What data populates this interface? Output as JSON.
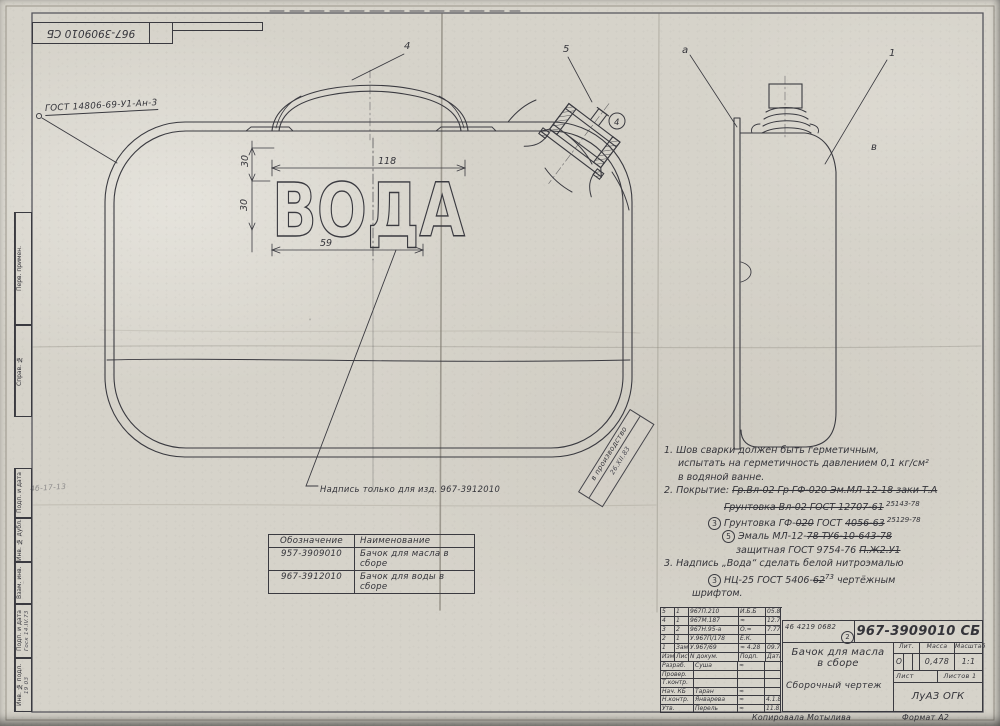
{
  "sheet": {
    "top_doc_number": "967-3909010 СБ",
    "gost_callout": "ГОСТ 14806-69-У1-Ан-3",
    "word_mark": "ВОДА",
    "inscription_note": "Надпись только для изд. 967-3912010",
    "stamp_line1": "в производство",
    "stamp_line2": "26.XII.83",
    "left_scrawl": "4б-17-13",
    "copied_by": "Копировала  Мотылива",
    "format_label": "Формат А2"
  },
  "dims": {
    "w118": "118",
    "w59": "59",
    "h30a": "30",
    "h30b": "30"
  },
  "callouts": {
    "handle": "4",
    "neck": "5",
    "cap": "4",
    "view_a": "а",
    "item1": "1",
    "view_v": "в"
  },
  "notes": [
    {
      "x": 0,
      "seg": [
        {
          "t": "1.  Шов сварки должен быть герметичным,"
        }
      ]
    },
    {
      "x": 14,
      "seg": [
        {
          "t": "испытать на герметичность давлением 0,1 кг/см²"
        }
      ]
    },
    {
      "x": 14,
      "seg": [
        {
          "t": "в водяной ванне."
        }
      ]
    },
    {
      "x": 0,
      "seg": [
        {
          "t": "2.  Покрытие: "
        },
        {
          "t": "Гр.Вл-02 Гр ГФ-020 Эм.МЛ-12-18 заки Т.А",
          "s": true
        }
      ]
    },
    {
      "x": 60,
      "seg": [
        {
          "t": "Грунтовка Вл-02 ГОСТ 12707-61",
          "s": true
        },
        {
          "t": " 25143-78",
          "sup": true
        }
      ]
    },
    {
      "x": 44,
      "seg": [
        {
          "c": "3"
        },
        {
          "t": "  Грунтовка ГФ-"
        },
        {
          "t": "020",
          "s": true
        },
        {
          "t": " ГОСТ "
        },
        {
          "t": "4056-63",
          "s": true
        },
        {
          "t": " 25129-78",
          "sup": true
        }
      ]
    },
    {
      "x": 58,
      "seg": [
        {
          "c": "5"
        },
        {
          "t": "  Эмаль МЛ-12-"
        },
        {
          "t": "78 ТУ6-10-643-78",
          "s": true
        }
      ]
    },
    {
      "x": 72,
      "seg": [
        {
          "t": "защитная ГОСТ 9754-76 "
        },
        {
          "t": "П.Ж2.У1",
          "s": true
        }
      ]
    },
    {
      "x": 0,
      "seg": [
        {
          "t": "3.  Надпись „Вода“ сделать белой нитроэмалью"
        }
      ]
    },
    {
      "x": 44,
      "seg": [
        {
          "c": "3"
        },
        {
          "t": "  НЦ-25 ГОСТ 5406-"
        },
        {
          "t": "62",
          "s": true
        },
        {
          "t": "73",
          "sup": true
        },
        {
          "t": " чертёжным"
        }
      ]
    },
    {
      "x": 28,
      "seg": [
        {
          "t": "шрифтом."
        }
      ]
    }
  ],
  "parts_table": {
    "headers": [
      "Обозначение",
      "Наименование"
    ],
    "rows": [
      [
        "957-3909010",
        "Бачок для масла в сборе"
      ],
      [
        "967-3912010",
        "Бачок для воды в сборе"
      ]
    ]
  },
  "title_block": {
    "code": "46 4219 0682",
    "code_circle": "2",
    "doc_number": "967-3909010 СБ",
    "title1": "Бачок для масла",
    "title2": "в сборе",
    "doc_type": "Сборочный чертеж",
    "lit_label": "Лит.",
    "lit_value": "О",
    "mass_label": "Масса",
    "mass_value": "0,478",
    "scale_label": "Масштаб",
    "scale_value": "1:1",
    "sheet_label": "Лист",
    "sheets_label": "Листов 1",
    "org": "ЛуАЗ  ОГК",
    "rev_header": [
      "Изм.",
      "Лист",
      "N докум.",
      "Подп.",
      "Дата"
    ],
    "rev_rows": [
      [
        "5",
        "1",
        "967П.210",
        "И.Б.Б",
        "05.81"
      ],
      [
        "4",
        "1",
        "967М.187",
        "≈",
        "12.78"
      ],
      [
        "3",
        "2",
        "967Н.95-а",
        "О.≈",
        "7.77"
      ],
      [
        "2",
        "1",
        "У.967П/178",
        "Е.К.",
        ""
      ],
      [
        "1",
        "Зам.",
        "У.967/69",
        "≈ 4.28",
        "09.76"
      ]
    ],
    "staff_rows": [
      [
        "Разраб.",
        "Суша",
        "≈",
        ""
      ],
      [
        "Провер.",
        "",
        "",
        ""
      ],
      [
        "Т.контр.",
        "",
        "",
        ""
      ],
      [
        "Нач. КБ",
        "Таран",
        "≈",
        ""
      ],
      [
        "Н.контр.",
        "Январева",
        "≈",
        "4.1.83"
      ],
      [
        "Утв.",
        "Перель",
        "≈",
        "11.81"
      ]
    ]
  },
  "margin_labels": [
    {
      "label": "Перв. примен.",
      "value": ""
    },
    {
      "label": "Справ. №",
      "value": ""
    },
    {
      "label": "Подп. и дата",
      "value": ""
    },
    {
      "label": "Инв. № дубл.",
      "value": ""
    },
    {
      "label": "Взам. инв. №",
      "value": ""
    },
    {
      "label": "Подп. и дата",
      "value": "Госк 14.IV.73"
    },
    {
      "label": "Инв. № подл.",
      "value": "19 03"
    }
  ]
}
